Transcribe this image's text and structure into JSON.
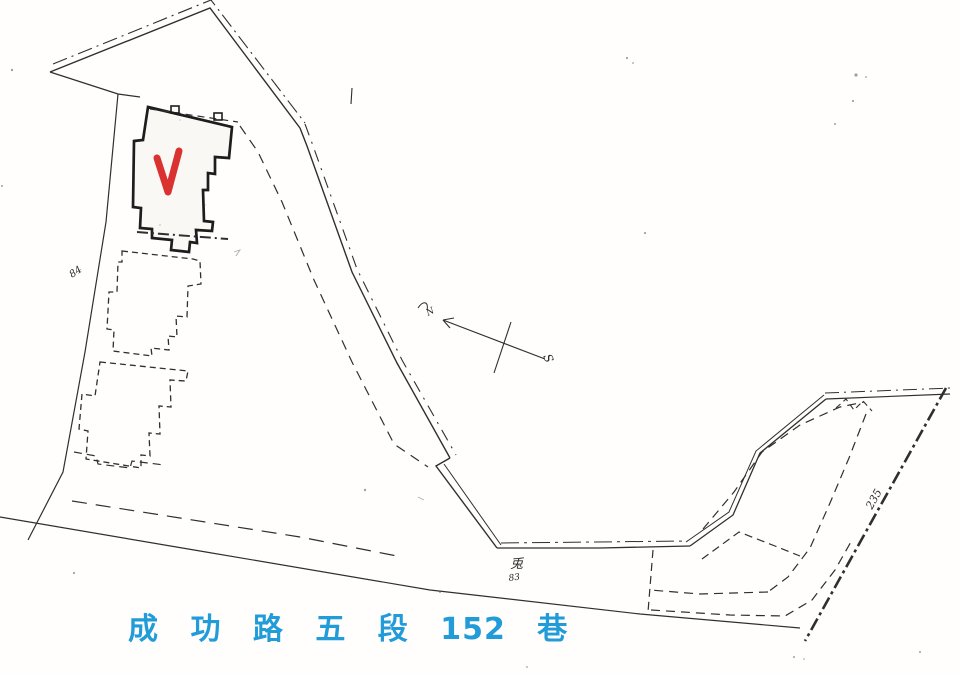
{
  "document_type": "scanned cadastral sketch map",
  "colors": {
    "paper": "#fffefd",
    "ink": "#2f2f2f",
    "accent_blue": "#219cd8",
    "check_red": "#d93230"
  },
  "street_label": "成 功 路 五 段 152 巷",
  "compass": {
    "north_label": "N",
    "south_label": "S"
  },
  "annotations": {
    "left_boundary_number": "84",
    "center_mark": "兎",
    "center_number": "83",
    "right_boundary_number": "235"
  },
  "marks": {
    "selected_parcel_check": "red check mark on selected building parcel"
  }
}
